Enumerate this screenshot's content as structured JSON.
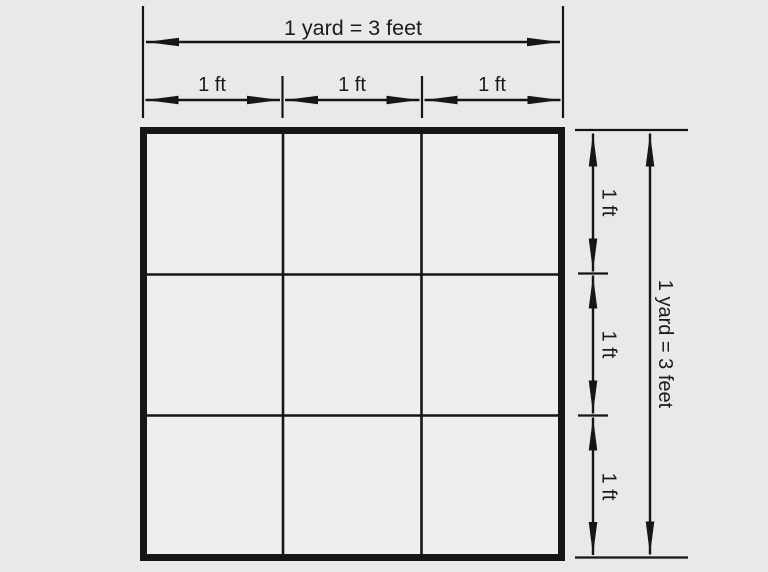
{
  "colors": {
    "background": "#e9e9e9",
    "line": "#161616",
    "square_fill": "#eeeeee"
  },
  "square_grid": {
    "rows": 3,
    "cols": 3
  },
  "dimensions": {
    "top_total": {
      "label": "1 yard = 3 feet"
    },
    "top_segments": [
      {
        "label": "1 ft"
      },
      {
        "label": "1 ft"
      },
      {
        "label": "1 ft"
      }
    ],
    "right_total": {
      "label": "1 yard = 3 feet"
    },
    "right_segments": [
      {
        "label": "1 ft"
      },
      {
        "label": "1 ft"
      },
      {
        "label": "1 ft"
      }
    ]
  }
}
